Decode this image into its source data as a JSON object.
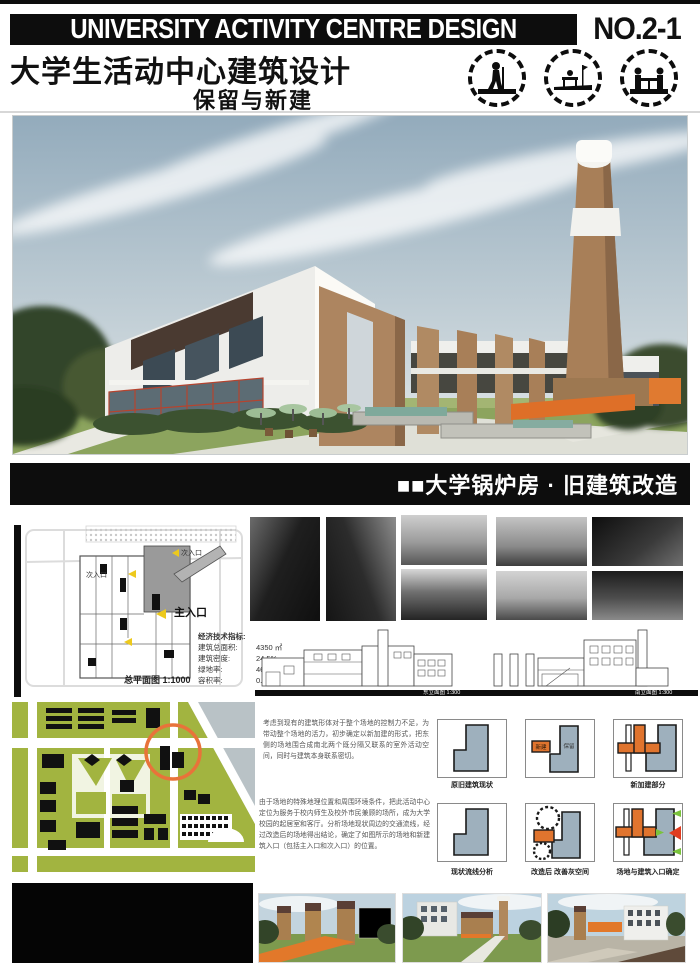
{
  "header": {
    "title_en": "UNIVERSITY ACTIVITY CENTRE DESIGN",
    "sheet_no": "NO.2-1",
    "title_cn": "大学生活动中心建筑设计",
    "subtitle_cn": "保留与新建",
    "stamps": [
      "figure-activity-stamp-1",
      "figure-bench-stamp-2",
      "figure-table-stamp-3"
    ]
  },
  "banner": {
    "label": "■■大学锅炉房 · 旧建筑改造"
  },
  "site_plan": {
    "entrance_secondary_top": "次入口",
    "entrance_secondary": "次入口",
    "entrance_main": "主入口",
    "caption": "总平面图  1:1000"
  },
  "indicators": {
    "heading": "经济技术指标:",
    "rows": [
      {
        "label": "建筑总面积:",
        "value": "4350 ㎡"
      },
      {
        "label": "建筑密度:",
        "value": "24.5%"
      },
      {
        "label": "绿地率:",
        "value": "46%"
      },
      {
        "label": "容积率:",
        "value": "0.57"
      }
    ]
  },
  "elevations": [
    {
      "caption": "东立面图  1:300"
    },
    {
      "caption": "南立面图  1:300"
    }
  ],
  "paragraphs": [
    "考虑到现有的建筑形体对于整个场地的控制力不足，为带动整个场地的活力，初步确定以新加建的形式，把东侧的场地围合成南北两个既分隔又联系的室外活动空间，同时与建筑本身联系密切。",
    "由于场地的特殊地理位置和周围环境条件，把此活动中心定位为服务于校内师生及校外市民兼顾的场所，成为大学校园的起居室和客厅。分析场地现状周边的交通流线，经过改造后的场地得出结论，确定了如图所示的场地和新建筑入口（包括主入口和次入口）的位置。"
  ],
  "diagrams": {
    "cells": [
      {
        "caption": "原旧建筑现状"
      },
      {
        "caption": "",
        "tag_new": "新建",
        "tag_keep": "保留"
      },
      {
        "caption": "新加建部分"
      },
      {
        "caption": "现状流线分析"
      },
      {
        "caption": "改造后 改善灰空间"
      },
      {
        "caption": "场地与建筑入口确定"
      }
    ]
  },
  "colors": {
    "banner_black": "#0d0d0d",
    "accent_orange": "#e0742e",
    "map_olive": "#a2b440",
    "water_gray": "#b9c2c6",
    "diagram_gray": "#9eb0bd",
    "arrow_yellow": "#edc91c",
    "arrow_green": "#7ac33c",
    "arrow_red": "#e03c20",
    "brick_tan": "#ad8560",
    "lawn_green": "#8ca45e"
  }
}
